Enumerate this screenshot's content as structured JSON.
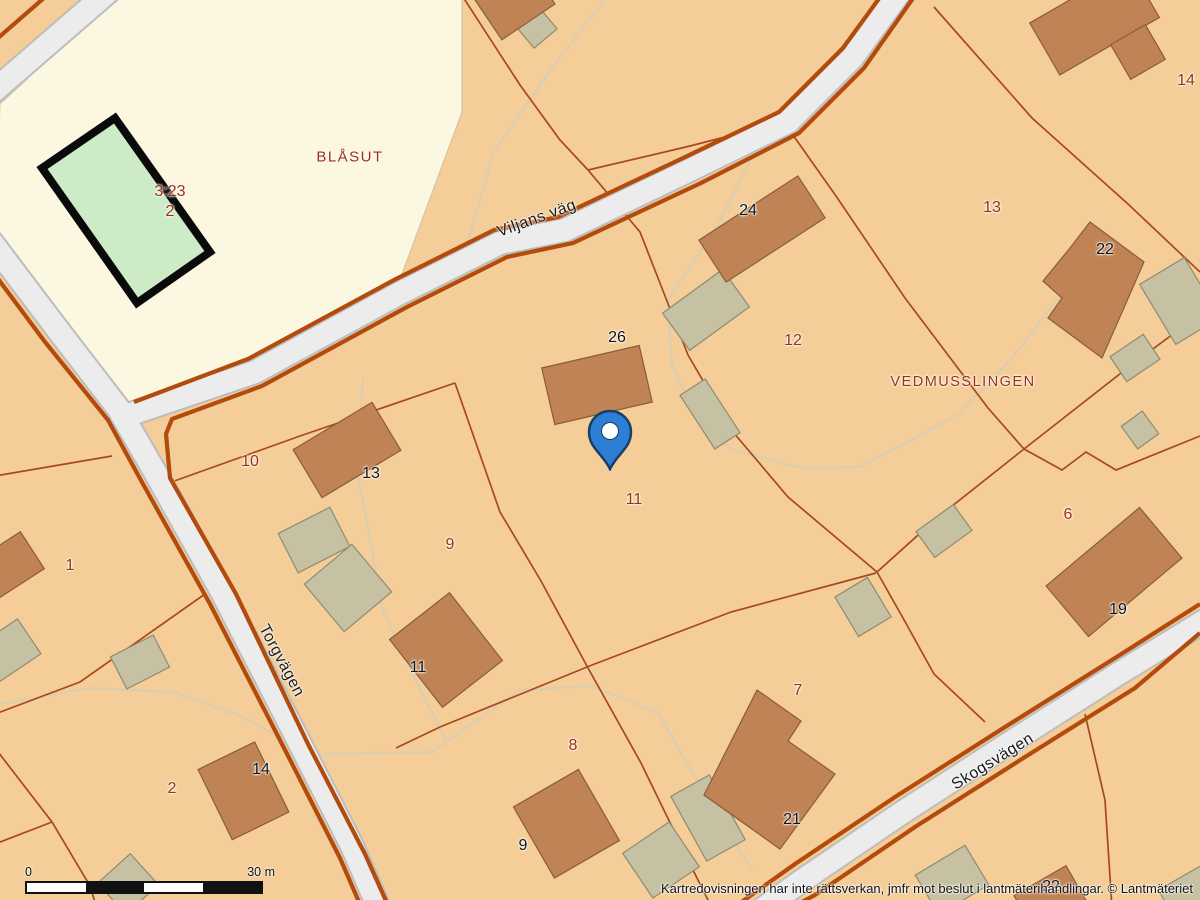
{
  "map": {
    "labels": [
      {
        "text": "BLÅSUT",
        "x": 350,
        "y": 157,
        "cls": "place",
        "size": 15
      },
      {
        "text": "VEDMUSSLINGEN",
        "x": 963,
        "y": 382,
        "cls": "place",
        "size": 14.5
      },
      {
        "text": "3:23",
        "x": 170,
        "y": 192,
        "cls": "parcel",
        "size": 16
      },
      {
        "text": "2",
        "x": 170,
        "y": 212,
        "cls": "parcel",
        "size": 16
      },
      {
        "text": "10",
        "x": 250,
        "y": 462,
        "cls": "parcel",
        "size": 16
      },
      {
        "text": "9",
        "x": 450,
        "y": 545,
        "cls": "parcel",
        "size": 16
      },
      {
        "text": "1",
        "x": 70,
        "y": 566,
        "cls": "parcel",
        "size": 16
      },
      {
        "text": "2",
        "x": 172,
        "y": 789,
        "cls": "parcel",
        "size": 16
      },
      {
        "text": "8",
        "x": 573,
        "y": 746,
        "cls": "parcel",
        "size": 16
      },
      {
        "text": "7",
        "x": 798,
        "y": 691,
        "cls": "parcel",
        "size": 16
      },
      {
        "text": "11",
        "x": 634,
        "y": 500,
        "cls": "parcel",
        "size": 16
      },
      {
        "text": "12",
        "x": 793,
        "y": 341,
        "cls": "parcel",
        "size": 16
      },
      {
        "text": "13",
        "x": 992,
        "y": 208,
        "cls": "parcel",
        "size": 16
      },
      {
        "text": "14",
        "x": 1186,
        "y": 81,
        "cls": "parcel",
        "size": 16
      },
      {
        "text": "6",
        "x": 1068,
        "y": 515,
        "cls": "parcel",
        "size": 16
      },
      {
        "text": "24",
        "x": 748,
        "y": 211,
        "cls": "building",
        "size": 16
      },
      {
        "text": "26",
        "x": 617,
        "y": 338,
        "cls": "building",
        "size": 16
      },
      {
        "text": "13",
        "x": 371,
        "y": 474,
        "cls": "building",
        "size": 16
      },
      {
        "text": "11",
        "x": 418,
        "y": 668,
        "cls": "building",
        "size": 16
      },
      {
        "text": "14",
        "x": 261,
        "y": 770,
        "cls": "building",
        "size": 16
      },
      {
        "text": "9",
        "x": 523,
        "y": 846,
        "cls": "building",
        "size": 16
      },
      {
        "text": "21",
        "x": 792,
        "y": 820,
        "cls": "building",
        "size": 16
      },
      {
        "text": "19",
        "x": 1118,
        "y": 610,
        "cls": "building",
        "size": 16
      },
      {
        "text": "22",
        "x": 1105,
        "y": 250,
        "cls": "building",
        "size": 16
      },
      {
        "text": "22",
        "x": 1051,
        "y": 887,
        "cls": "building",
        "size": 16
      },
      {
        "text": "Viljans väg",
        "x": 537,
        "y": 219,
        "cls": "street",
        "rot": -20,
        "size": 16
      },
      {
        "text": "Torgvägen",
        "x": 281,
        "y": 661,
        "cls": "street",
        "rot": 62,
        "size": 16
      },
      {
        "text": "Skogsvägen",
        "x": 993,
        "y": 762,
        "cls": "street",
        "rot": -32,
        "size": 16
      }
    ]
  },
  "marker": {
    "x": 610,
    "y": 430
  },
  "scalebar": {
    "x": 25,
    "y": 867,
    "width": 238,
    "height": 13,
    "start_label": "0",
    "end_label": "30 m"
  },
  "attribution": {
    "text": "Kartredovisningen har inte rättsverkan, jmfr mot beslut i lantmäterihandlingar. © Lantmäteriet"
  },
  "colors": {
    "parcel_fill": "#f4cd98",
    "block_fill": "#fcf7e0",
    "house_fill": "#c08355",
    "house_edge": "#8a5c38",
    "outbuilding_fill": "#c6c1a2",
    "outbuilding_edge": "#8f8b72",
    "sports_field_fill": "#cdebc6",
    "road_fill": "#ececec",
    "road_casing": "#bdbdbd",
    "road_edge": "#b24b0c",
    "boundary": "#a8491d",
    "trail": "#d9cdb4",
    "parcel_text": "#9e3012",
    "building_text": "#141414",
    "marker_blue": "#2e7ed3",
    "marker_outline": "#173f66"
  }
}
